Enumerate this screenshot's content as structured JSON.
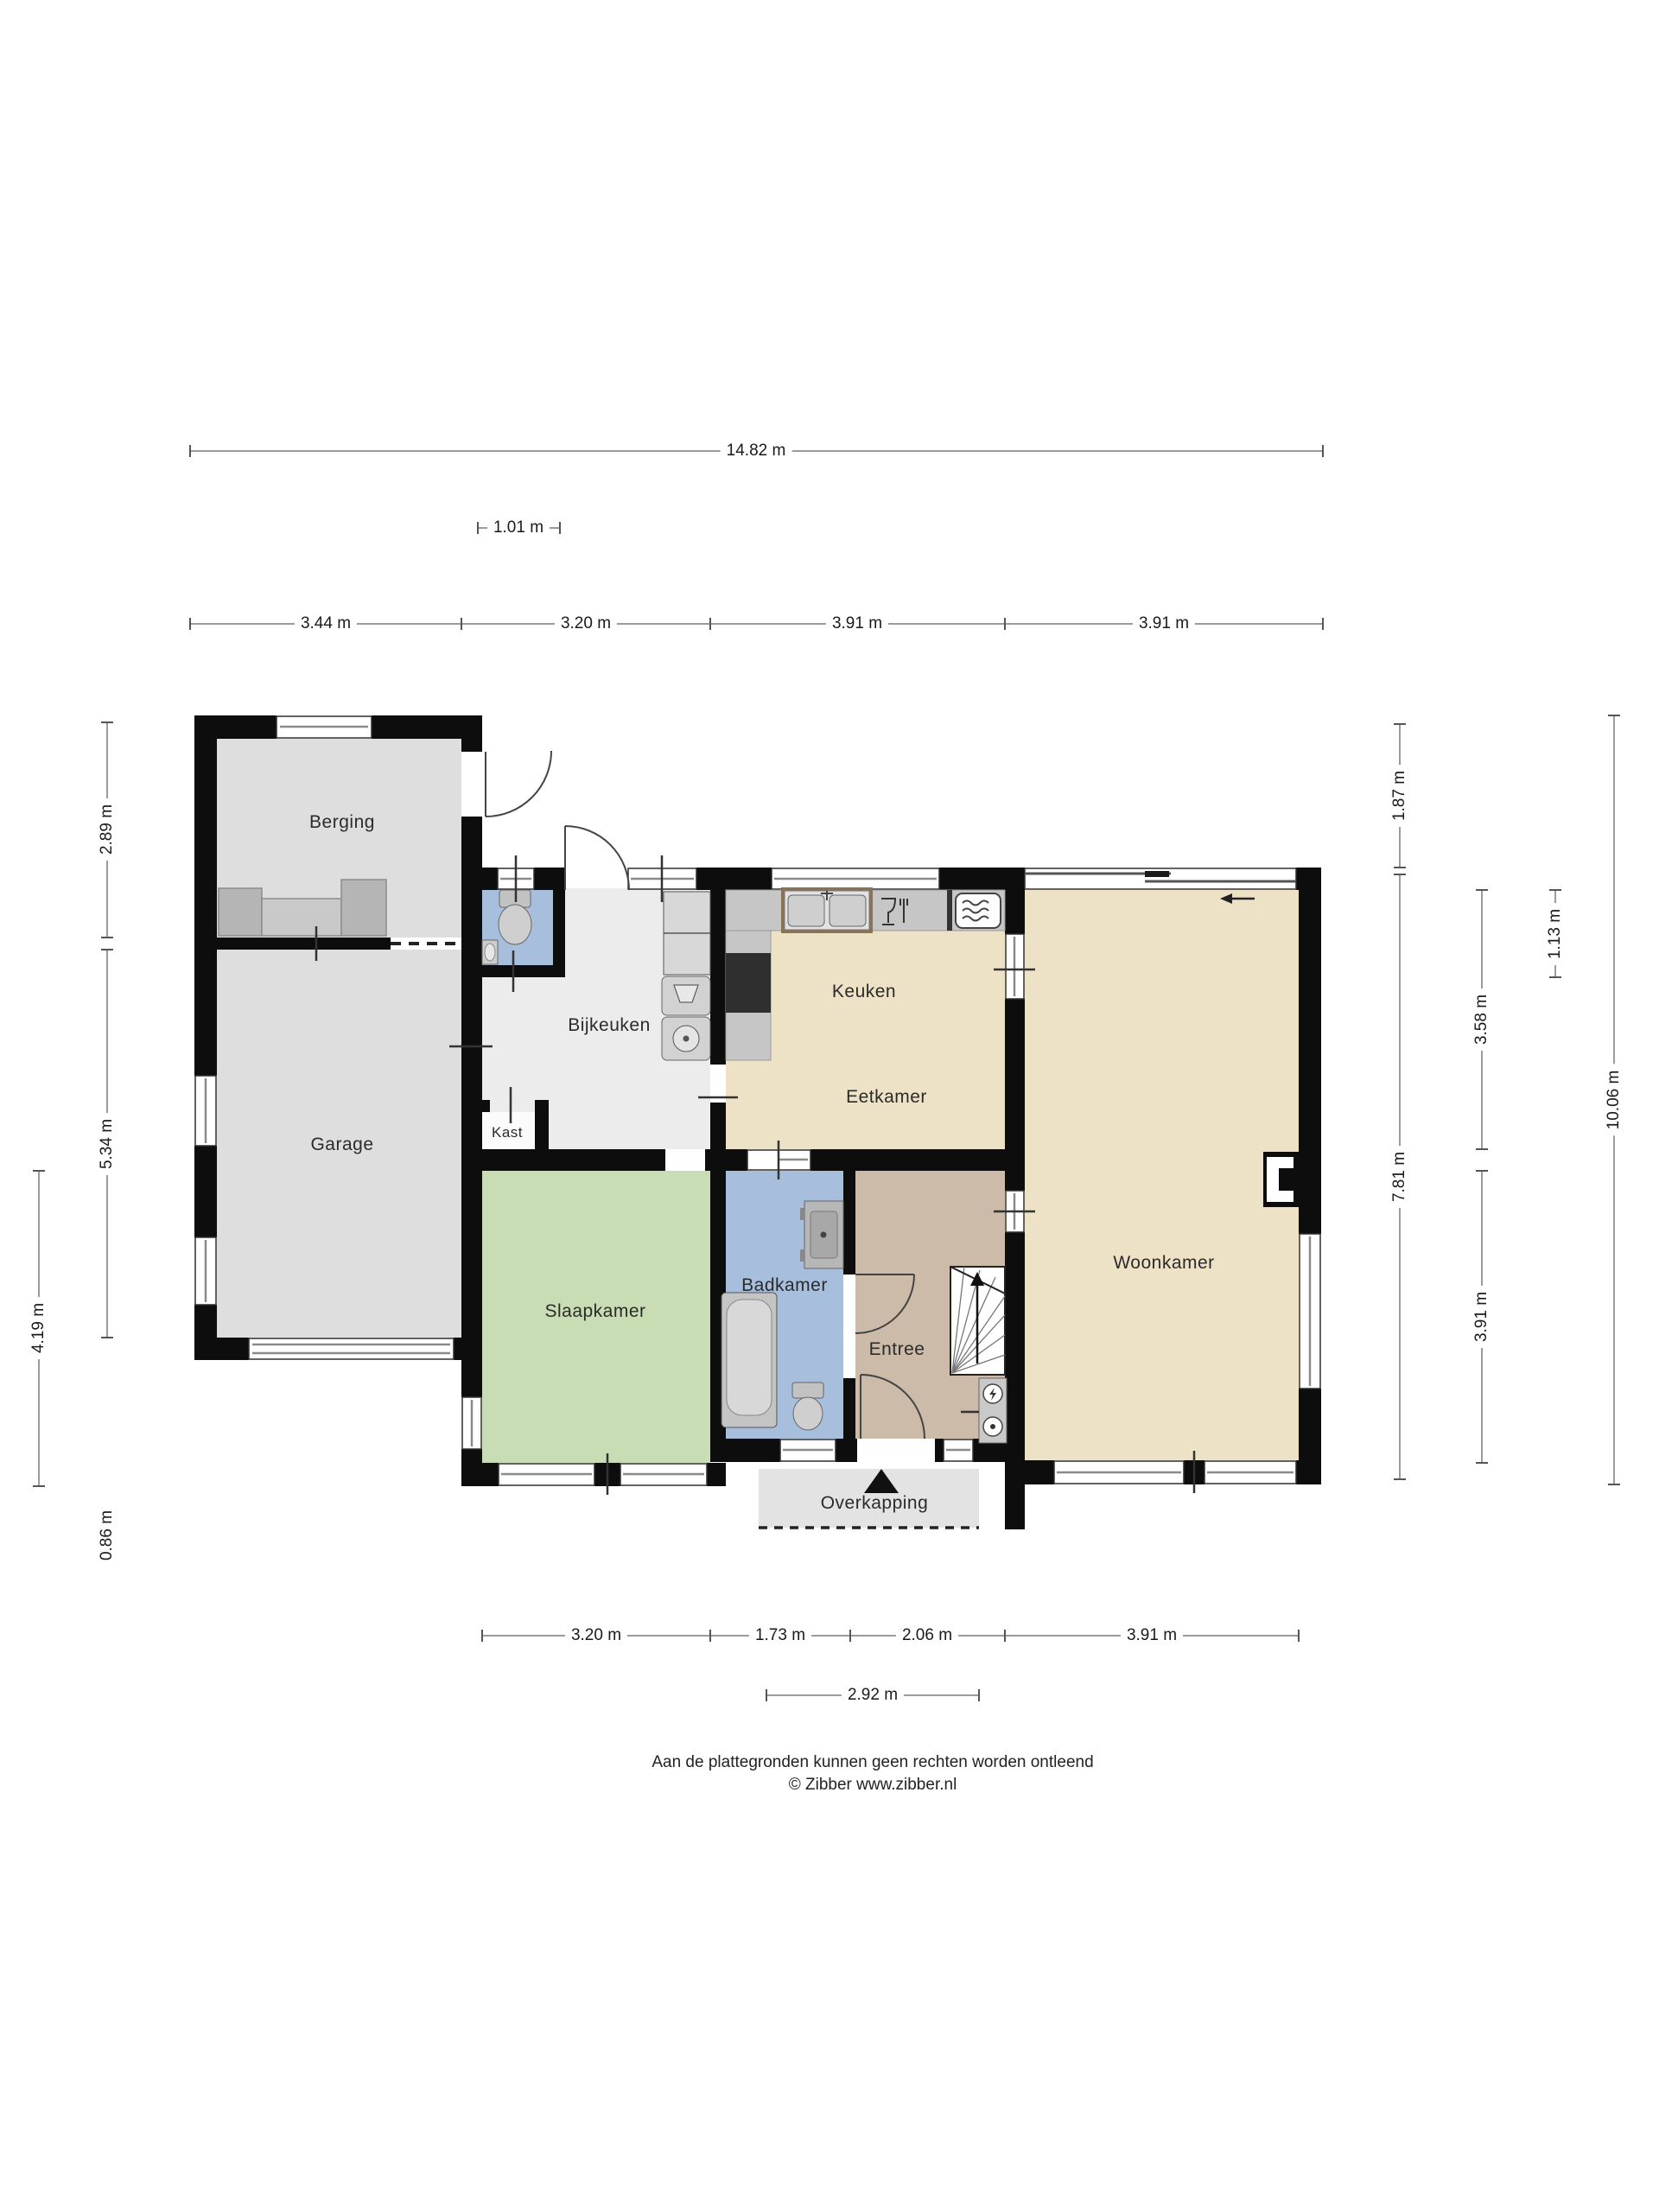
{
  "rooms": {
    "berging": "Berging",
    "garage": "Garage",
    "bijkeuken": "Bijkeuken",
    "kast": "Kast",
    "keuken": "Keuken",
    "eetkamer": "Eetkamer",
    "woonkamer": "Woonkamer",
    "slaapkamer": "Slaapkamer",
    "badkamer": "Badkamer",
    "entree": "Entree",
    "overkapping": "Overkapping"
  },
  "dimensions": {
    "total_width": "14.82 m",
    "top_offset": "1.01 m",
    "top_segments": [
      "3.44 m",
      "3.20 m",
      "3.91 m",
      "3.91 m"
    ],
    "left": [
      "2.89 m",
      "5.34 m",
      "4.19 m",
      "0.86 m"
    ],
    "right": [
      "1.87 m",
      "7.81 m",
      "3.58 m",
      "3.91 m",
      "1.13 m",
      "10.06 m"
    ],
    "bottom_segments": [
      "3.20 m",
      "1.73 m",
      "2.06 m",
      "3.91 m"
    ],
    "bottom_porch": "2.92 m"
  },
  "footer": {
    "disclaimer": "Aan de plattegronden kunnen geen rechten worden ontleend",
    "copyright": "© Zibber www.zibber.nl"
  },
  "colors": {
    "wall": "#0d0d0d",
    "floor_gray": "#dedede",
    "floor_light": "#ececec",
    "floor_cream": "#ede1c6",
    "floor_green": "#c8ddb4",
    "floor_blue": "#a7bfdc",
    "floor_tan": "#cbbba8",
    "floor_porch": "#e3e3e3",
    "counter": "#c6c6c6",
    "cooktop": "#2f2f2f"
  }
}
